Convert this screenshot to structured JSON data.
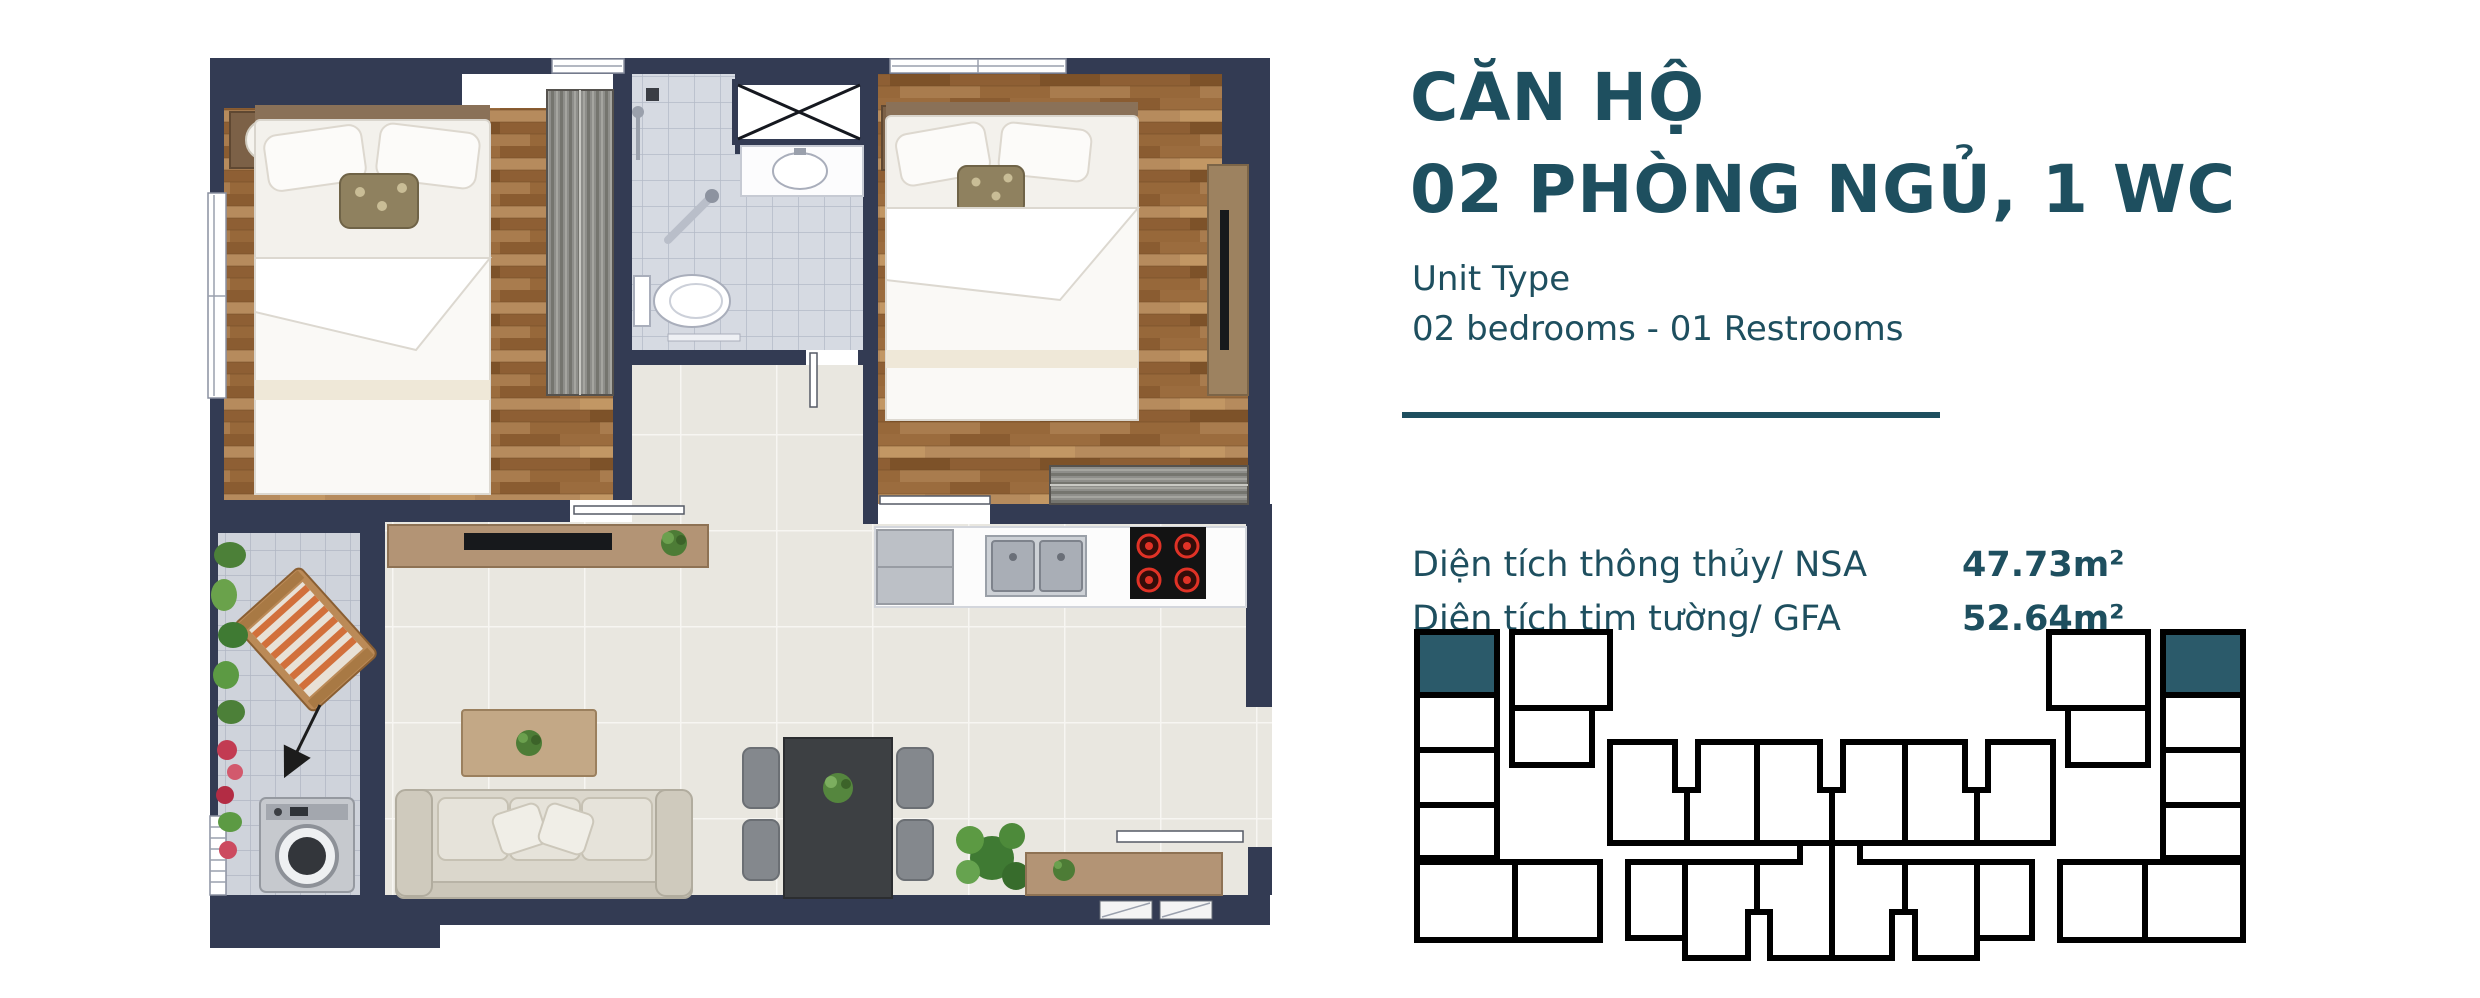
{
  "panel": {
    "title_line1": "CĂN HỘ",
    "title_line2": "02 PHÒNG NGỦ, 1 WC",
    "unit_type_label": "Unit Type",
    "unit_type_value": "02 bedrooms - 01 Restrooms",
    "areas": [
      {
        "label": "Diện tích thông thủy/ NSA",
        "value": "47.73m²"
      },
      {
        "label": "Diện tích tim tường/ GFA",
        "value": "52.64m²"
      }
    ]
  },
  "colors": {
    "accent": "#1e4f5f",
    "wall": "#333b53",
    "key_highlight": "#2b5a6a"
  },
  "key_plan": {
    "highlighted_count": 2,
    "highlight_position": "top corner units of left and right wings"
  },
  "floor_plan": {
    "rooms": [
      "bedroom-1",
      "bathroom",
      "bedroom-2",
      "living-dining",
      "kitchen",
      "balcony"
    ],
    "fixtures": [
      "double-bed x2",
      "wardrobe x2",
      "toilet",
      "sink",
      "shower",
      "kitchen-counter",
      "double-sink",
      "stove-4-burners",
      "fridge",
      "tv-console",
      "sofa",
      "coffee-table",
      "dining-table-4-chairs",
      "washing-machine",
      "lounge-chair",
      "plants",
      "vent-shaft",
      "entry-door"
    ]
  }
}
